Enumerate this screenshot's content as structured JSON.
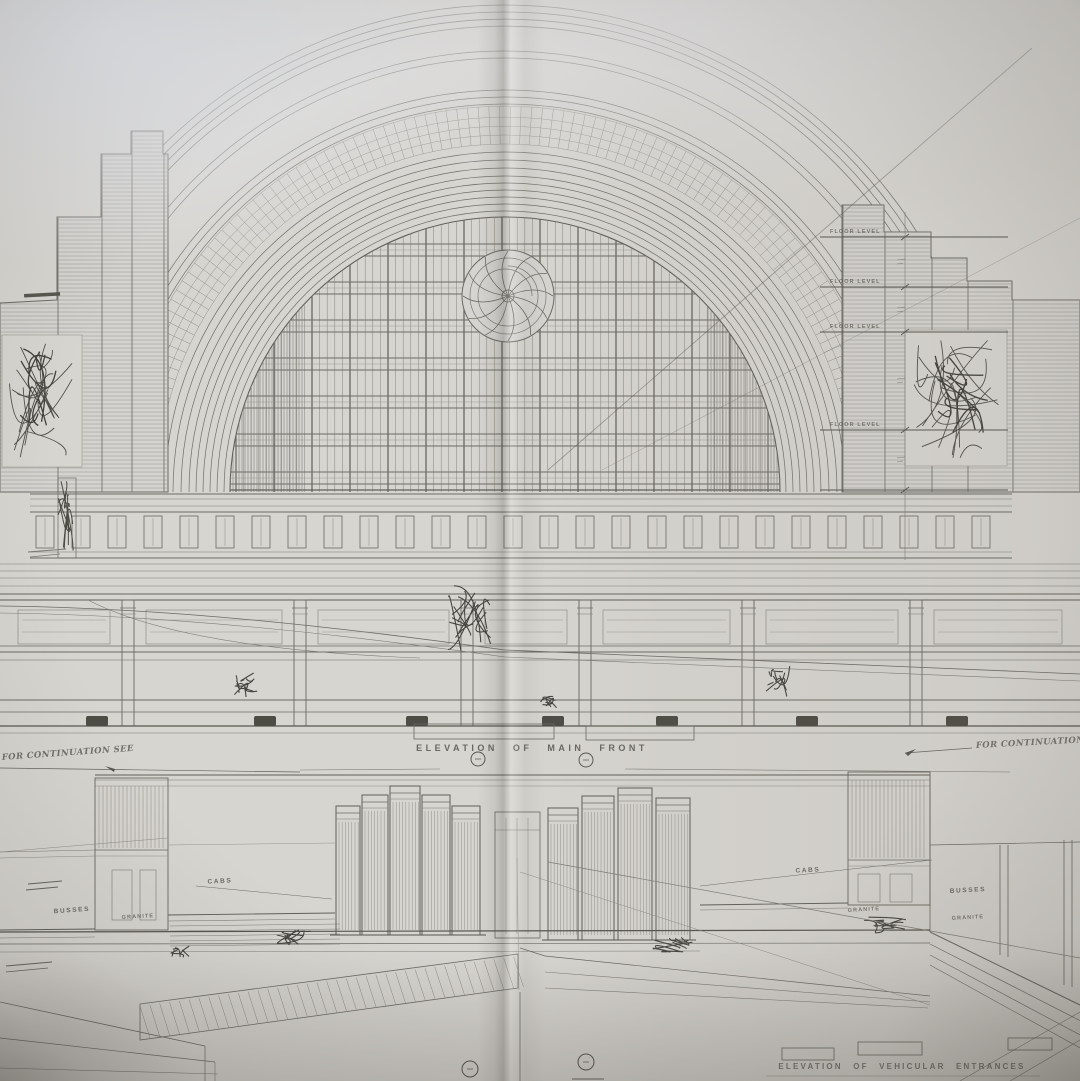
{
  "scene": {
    "type": "photographed architectural drawing, book spread",
    "subject": "Art-deco railway terminal front elevation with arched half-dome facade",
    "paper_color": "#d7d5d0",
    "ink_color": "#6e6d66",
    "dark_ink_color": "#4e4d46"
  },
  "upper_elevation": {
    "title": "ELEVATION OF MAIN FRONT",
    "floor_level_label": "FLOOR LEVEL",
    "note_left": "FOR CONTINUATION SEE",
    "note_right": "FOR CONTINUATION SEE"
  },
  "lower_elevation": {
    "title": "ELEVATION OF VEHICULAR ENTRANCES",
    "cabs_label": "CABS",
    "busses_label": "BUSSES",
    "granite_label": "GRANITE"
  }
}
